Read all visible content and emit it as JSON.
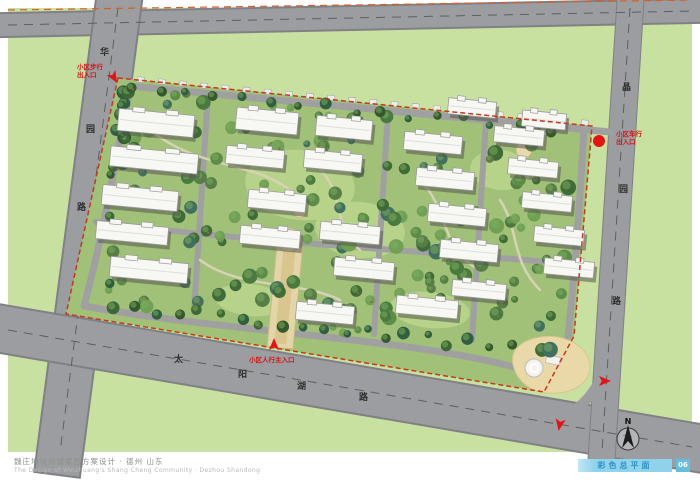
{
  "title_block": {
    "line_cn": "魏庄地块尚城家园方案设计 · 德州 山东",
    "line_en": "The Design of Weizhuang's Shang Cheng Community · Dezhou Shandong"
  },
  "sheet": {
    "label": "彩色总平面",
    "number": "06"
  },
  "north_arrow": {
    "label": "N"
  },
  "roads": {
    "west": {
      "name": "华园路",
      "chars": [
        {
          "c": "华",
          "x": 100,
          "y": 49
        },
        {
          "c": "园",
          "x": 86,
          "y": 126
        },
        {
          "c": "路",
          "x": 77,
          "y": 204
        }
      ]
    },
    "south": {
      "name": "太阳湖路",
      "chars": [
        {
          "c": "太",
          "x": 174,
          "y": 356
        },
        {
          "c": "阳",
          "x": 238,
          "y": 371
        },
        {
          "c": "湖",
          "x": 297,
          "y": 383
        },
        {
          "c": "路",
          "x": 359,
          "y": 394
        }
      ]
    },
    "east": {
      "name": "晶园路",
      "chars": [
        {
          "c": "晶",
          "x": 622,
          "y": 84
        },
        {
          "c": "园",
          "x": 619,
          "y": 186
        },
        {
          "c": "路",
          "x": 612,
          "y": 298
        }
      ]
    }
  },
  "entrances": [
    {
      "id": "west-pedestrian",
      "lines": [
        "小区步行",
        "出入口"
      ],
      "lx": 77,
      "ly": 64,
      "marker": {
        "kind": "arrow",
        "x": 113,
        "y": 76,
        "angle": 150
      }
    },
    {
      "id": "east-vehicle",
      "lines": [
        "小区车行",
        "出入口"
      ],
      "lx": 616,
      "ly": 131,
      "marker": {
        "kind": "dot",
        "x": 599,
        "y": 141
      }
    },
    {
      "id": "south-main",
      "lines": [
        "小区人行主入口"
      ],
      "lx": 249,
      "ly": 357,
      "marker": {
        "kind": "arrow",
        "x": 274,
        "y": 346,
        "angle": 0
      }
    },
    {
      "id": "se-vehicle-1",
      "lines": [],
      "lx": 0,
      "ly": 0,
      "marker": {
        "kind": "arrow",
        "x": 603,
        "y": 381,
        "angle": 90
      }
    },
    {
      "id": "se-vehicle-2",
      "lines": [],
      "lx": 0,
      "ly": 0,
      "marker": {
        "kind": "arrow",
        "x": 560,
        "y": 423,
        "angle": 190
      }
    }
  ],
  "site": {
    "rotation_deg": 5.5,
    "buildings": [
      {
        "x": 118,
        "y": 112,
        "w": 76,
        "h": 22
      },
      {
        "x": 110,
        "y": 150,
        "w": 88,
        "h": 20
      },
      {
        "x": 102,
        "y": 188,
        "w": 76,
        "h": 20
      },
      {
        "x": 96,
        "y": 224,
        "w": 72,
        "h": 18
      },
      {
        "x": 110,
        "y": 260,
        "w": 78,
        "h": 20
      },
      {
        "x": 236,
        "y": 110,
        "w": 62,
        "h": 22
      },
      {
        "x": 226,
        "y": 148,
        "w": 58,
        "h": 18
      },
      {
        "x": 248,
        "y": 192,
        "w": 58,
        "h": 18
      },
      {
        "x": 240,
        "y": 228,
        "w": 60,
        "h": 18
      },
      {
        "x": 316,
        "y": 118,
        "w": 56,
        "h": 20
      },
      {
        "x": 304,
        "y": 152,
        "w": 58,
        "h": 18
      },
      {
        "x": 320,
        "y": 224,
        "w": 60,
        "h": 18
      },
      {
        "x": 334,
        "y": 260,
        "w": 60,
        "h": 18
      },
      {
        "x": 296,
        "y": 304,
        "w": 58,
        "h": 18
      },
      {
        "x": 404,
        "y": 134,
        "w": 58,
        "h": 18
      },
      {
        "x": 416,
        "y": 170,
        "w": 58,
        "h": 18
      },
      {
        "x": 428,
        "y": 206,
        "w": 58,
        "h": 18
      },
      {
        "x": 440,
        "y": 242,
        "w": 58,
        "h": 18
      },
      {
        "x": 396,
        "y": 298,
        "w": 62,
        "h": 18
      },
      {
        "x": 452,
        "y": 282,
        "w": 54,
        "h": 16
      },
      {
        "x": 448,
        "y": 100,
        "w": 48,
        "h": 16
      },
      {
        "x": 522,
        "y": 112,
        "w": 44,
        "h": 16
      },
      {
        "x": 494,
        "y": 128,
        "w": 50,
        "h": 16
      },
      {
        "x": 508,
        "y": 160,
        "w": 50,
        "h": 16
      },
      {
        "x": 522,
        "y": 194,
        "w": 50,
        "h": 16
      },
      {
        "x": 534,
        "y": 228,
        "w": 50,
        "h": 16
      },
      {
        "x": 544,
        "y": 260,
        "w": 50,
        "h": 16
      }
    ]
  },
  "colors": {
    "bg_outer": "#c8e0a0",
    "bg_site": "#a2c178",
    "road": "#9b9da0",
    "road_edge": "#7f8184",
    "building": "#f7f7f3",
    "building_shadow": "#55584f",
    "boundary_red": "#c23a22",
    "marker_red": "#e21414",
    "beach": "#ead9a8",
    "water": "#b9d7e2",
    "lawn": "#b9d48b",
    "bar_blue": "#8ed2ec",
    "bar_text": "#2e93c2",
    "page_num_bg": "#66bede"
  }
}
